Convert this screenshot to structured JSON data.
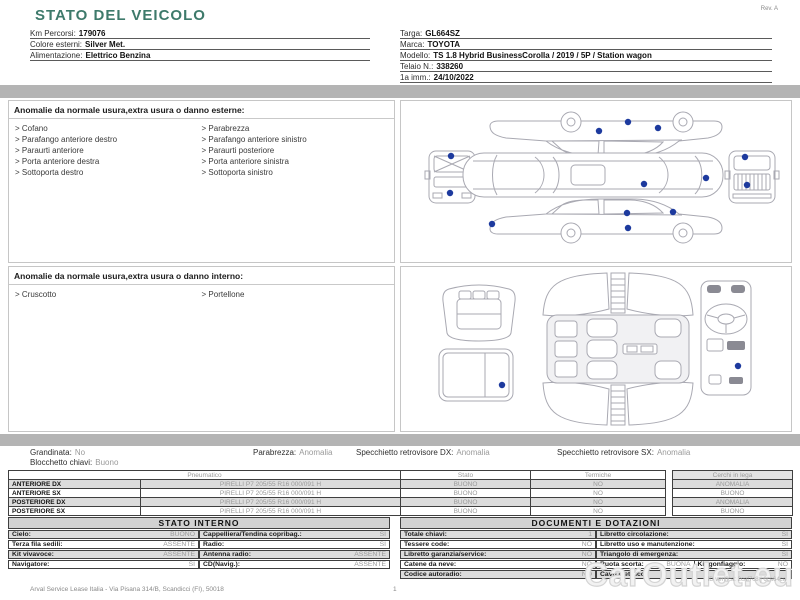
{
  "header": {
    "title": "STATO DEL VEICOLO",
    "rev": "Rev. A",
    "left_fields": [
      {
        "label": "Km Percorsi:",
        "value": "179076"
      },
      {
        "label": "Colore esterni:",
        "value": "Silver Met."
      },
      {
        "label": "Alimentazione:",
        "value": "Elettrico Benzina"
      }
    ],
    "right_fields": [
      {
        "label": "Targa:",
        "value": "GL664SZ"
      },
      {
        "label": "Marca:",
        "value": "TOYOTA"
      },
      {
        "label": "Modello:",
        "value": "TS 1.8 Hybrid BusinessCorolla / 2019 / 5P / Station wagon"
      },
      {
        "label": "Telaio N.:",
        "value": "338260"
      },
      {
        "label": "1a imm.:",
        "value": "24/10/2022"
      }
    ]
  },
  "external_anomalies": {
    "title": "Anomalie da normale usura,extra usura o danno esterne:",
    "col1": [
      "Cofano",
      "Parafango anteriore destro",
      "Paraurti anteriore",
      "Porta anteriore destra",
      "Sottoporta destro"
    ],
    "col2": [
      "Parabrezza",
      "Parafango anteriore sinistro",
      "Paraurti posteriore",
      "Porta anteriore sinistra",
      "Sottoporta sinistro"
    ]
  },
  "internal_anomalies": {
    "title": "Anomalie da normale usura,extra usura o danno interno:",
    "col1": [
      "Cruscotto"
    ],
    "col2": [
      "Portellone"
    ]
  },
  "summary": {
    "items": [
      {
        "label": "Grandinata:",
        "value": "No"
      },
      {
        "label": "Parabrezza:",
        "value": "Anomalia"
      },
      {
        "label": "Specchietto retrovisore DX:",
        "value": "Anomalia"
      },
      {
        "label": "Specchietto retrovisore SX:",
        "value": "Anomalia"
      }
    ],
    "second_line": {
      "label": "Blocchetto chiavi:",
      "value": "Buono"
    }
  },
  "tires": {
    "headers": {
      "pneumatico": "Pneumatico",
      "stato": "Stato",
      "termiche": "Termiche",
      "cerchi": "Cerchi in lega"
    },
    "rows": [
      {
        "position": "ANTERIORE DX",
        "spec": "PIRELLI P7 205/55 R16 000/091 H",
        "stato": "BUONO",
        "termiche": "NO",
        "cerchi": "ANOMALIA"
      },
      {
        "position": "ANTERIORE SX",
        "spec": "PIRELLI P7 205/55 R16 000/091 H",
        "stato": "BUONO",
        "termiche": "NO",
        "cerchi": "BUONO"
      },
      {
        "position": "POSTERIORE DX",
        "spec": "PIRELLI P7 205/55 R16 000/091 H",
        "stato": "BUONO",
        "termiche": "NO",
        "cerchi": "ANOMALIA"
      },
      {
        "position": "POSTERIORE SX",
        "spec": "PIRELLI P7 205/55 R16 000/091 H",
        "stato": "BUONO",
        "termiche": "NO",
        "cerchi": "BUONO"
      }
    ]
  },
  "stato_interno": {
    "title": "STATO INTERNO",
    "rows": [
      {
        "l1": "Cielo:",
        "v1": "BUONO",
        "l2": "Cappelliera/Tendina copribag.:",
        "v2": "SI"
      },
      {
        "l1": "Terza fila sedili:",
        "v1": "ASSENTE",
        "l2": "Radio:",
        "v2": "SI"
      },
      {
        "l1": "Kit vivavoce:",
        "v1": "ASSENTE",
        "l2": "Antenna radio:",
        "v2": "ASSENTE"
      },
      {
        "l1": "Navigatore:",
        "v1": "SI",
        "l2": "CD(Navig.):",
        "v2": "ASSENTE"
      }
    ]
  },
  "documenti": {
    "title": "DOCUMENTI E DOTAZIONI",
    "rows": [
      {
        "l1": "Totale chiavi:",
        "v1": "1",
        "l2": "Libretto circolazione:",
        "v2": "SI"
      },
      {
        "l1": "Tessere code:",
        "v1": "NO",
        "l2": "Libretto uso e manutenzione:",
        "v2": "SI"
      },
      {
        "l1": "Libretto garanzia/service:",
        "v1": "NO",
        "l2": "Triangolo di emergenza:",
        "v2": "SI"
      },
      {
        "l1": "Catene da neve:",
        "v1": "NO",
        "l2": "Ruota scorta:",
        "v2": "BUONA",
        "l3": "Kit gonfiaggio:",
        "v3": "NO"
      },
      {
        "l1": "Codice autoradio:",
        "v1": "NO",
        "l2": "Cavo elettrico:",
        "v2": ""
      }
    ]
  },
  "footer": {
    "company": "Arval Service Lease Italia - Via Pisana 314/B, Scandicci (FI), 50018",
    "page": "1",
    "watermark": "CarOutlet.eu",
    "id_text": "ID verifica: 2caf7c8 j 6ca64ca"
  },
  "colors": {
    "accent_title": "#3e7a6b",
    "anomaly_marker": "#1d3a9e",
    "separator_bar": "#b4b4b4",
    "row_stripe": "#dcdcdc"
  }
}
